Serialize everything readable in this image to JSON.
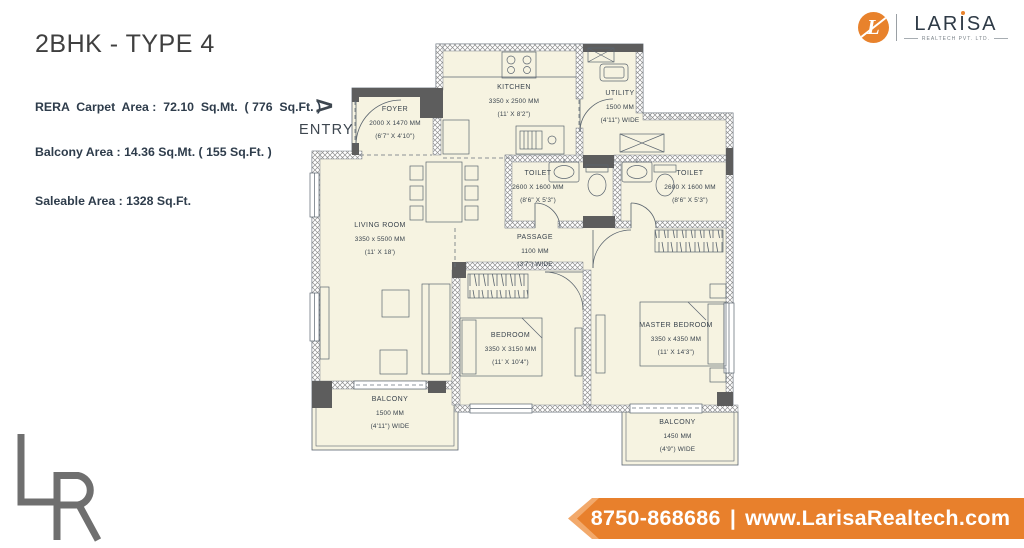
{
  "header": {
    "title": "2BHK - TYPE 4",
    "line1": "RERA  Carpet  Area :  72.10  Sq.Mt.  ( 776  Sq.Ft. )",
    "line2": "Balcony Area : 14.36 Sq.Mt. ( 155 Sq.Ft. )",
    "line3": "Saleable Area : 1328 Sq.Ft."
  },
  "logo": {
    "monogram": "L",
    "wordmark_pre": "LAR",
    "wordmark_i": "I",
    "wordmark_post": "SA",
    "tagline": "REALTECH PVT. LTD.",
    "accent_color": "#E8822C",
    "text_color": "#2E3A46"
  },
  "entry": {
    "arrow": ">",
    "label": "ENTRY"
  },
  "rooms": [
    {
      "name": "FOYER",
      "dim_mm": "2000 X 1470 MM",
      "dim_ft": "(6'7\" X 4'10\")"
    },
    {
      "name": "KITCHEN",
      "dim_mm": "3350 x 2500 MM",
      "dim_ft": "(11' X 8'2\")"
    },
    {
      "name": "UTILITY",
      "dim_mm": "1500 MM",
      "dim_ft": "(4'11\") WIDE"
    },
    {
      "name": "TOILET",
      "dim_mm": "2600 X 1600 MM",
      "dim_ft": "(8'6\" X 5'3\")"
    },
    {
      "name": "TOILET",
      "dim_mm": "2600 X 1600 MM",
      "dim_ft": "(8'6\" X 5'3\")"
    },
    {
      "name": "LIVING ROOM",
      "dim_mm": "3350 x 5500 MM",
      "dim_ft": "(11' X 18')"
    },
    {
      "name": "PASSAGE",
      "dim_mm": "1100 MM",
      "dim_ft": "(3'7\") WIDE"
    },
    {
      "name": "BEDROOM",
      "dim_mm": "3350 X 3150 MM",
      "dim_ft": "(11' X 10'4\")"
    },
    {
      "name": "MASTER BEDROOM",
      "dim_mm": "3350 x 4350 MM",
      "dim_ft": "(11' X 14'3\")"
    },
    {
      "name": "BALCONY",
      "dim_mm": "1500 MM",
      "dim_ft": "(4'11\") WIDE"
    },
    {
      "name": "BALCONY",
      "dim_mm": "1450 MM",
      "dim_ft": "(4'9\") WIDE"
    }
  ],
  "watermark": {
    "letters": "LR"
  },
  "footer": {
    "phone": "8750-868686",
    "separator": "|",
    "website": "www.LarisaRealtech.com",
    "bg_color": "#E8802C"
  }
}
